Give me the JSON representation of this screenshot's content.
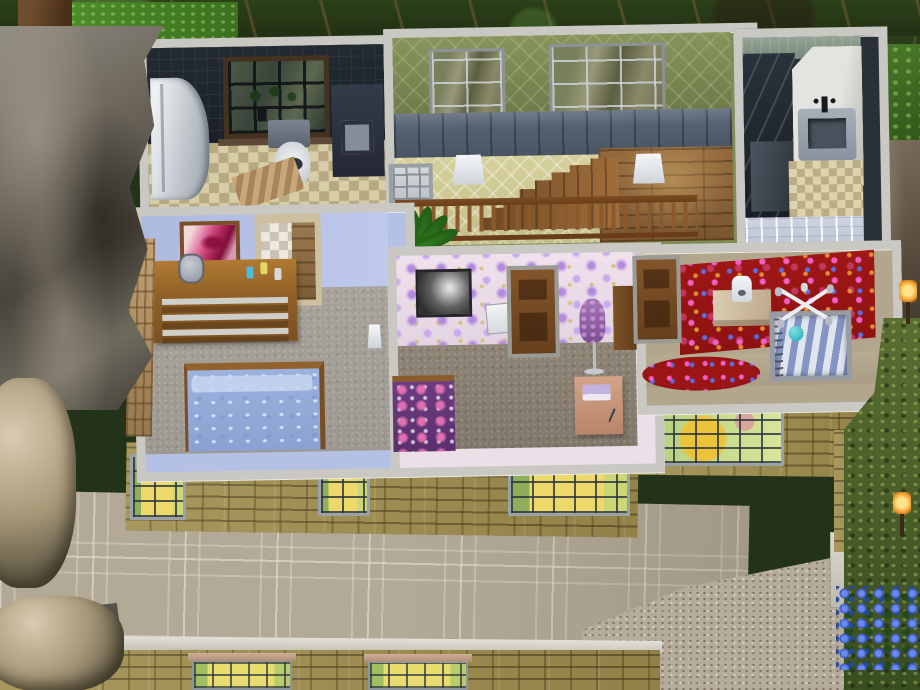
{
  "scene": {
    "view": "isometric dollhouse cutaway of a house upper floor, no HUD or text visible",
    "rooms": [
      {
        "id": "bathroom",
        "label": "Dark tile bathroom",
        "wall_color": "#20262e",
        "floor": "beige checker tile",
        "furniture": [
          "corner shower stall",
          "dark-framed window with vine",
          "toilet",
          "dark vanity cabinet",
          "wood bath mat",
          "toilet paper holder"
        ]
      },
      {
        "id": "stair-hall",
        "label": "Stair hall landing",
        "wall_color": "#7e8c55",
        "wainscot_color": "#5b6878",
        "floor": "wood planks",
        "furniture": [
          "two large windows",
          "wood staircase going down",
          "wood balustrade railing",
          "potted palm plant",
          "two white wall sconces",
          "interior pass-through window"
        ]
      },
      {
        "id": "shower-room",
        "label": "Narrow shower room",
        "wall_color": "#2a3038",
        "floor": "checker tile and pale blue tile",
        "furniture": [
          "dark glass shower",
          "white counter",
          "sink with black faucet"
        ]
      },
      {
        "id": "blue-bedroom",
        "label": "Periwinkle bedroom",
        "wall_color": "#b4c0e4",
        "floor": "gray carpet",
        "furniture": [
          "pink lips painting",
          "wood dresser with mirror and bottles",
          "closet doorway with checker wallpaper",
          "double bed with blue swirl bedding",
          "vine trellis on wall",
          "small wall sconce"
        ]
      },
      {
        "id": "sewing-room",
        "label": "Lavender floral room",
        "wall_color": "#ecdfe8",
        "floor": "brown carpet",
        "furniture": [
          "black and white portrait",
          "white wall cabinet",
          "wood panel door",
          "dress form mannequin in purple",
          "purple patterned bed",
          "sewing table with fabric and scissors",
          "brown wardrobe"
        ]
      },
      {
        "id": "nursery",
        "label": "Red nursery",
        "wall_color": "#9c1515",
        "floor": "tan carpet with round red rug",
        "furniture": [
          "wood panel door",
          "changing table with white potty chair",
          "crib with blue striped bedding and teal ball",
          "white baby mobile"
        ]
      }
    ],
    "exterior": {
      "wall_material": "tan brick",
      "roof": "coffered square panel flat roof",
      "cut_wall_color": "#c9c8c2",
      "lit_windows": 6,
      "window_glow": "yellow-green interior light",
      "areas": [
        "gravel patio lower right",
        "gray stone cliff left",
        "dense tree canopy top",
        "bushes right",
        "blue flowers bottom right",
        "white lower wall band"
      ],
      "lights": [
        "torch lamp upper right",
        "torch lamp lower right"
      ]
    },
    "palette": {
      "cut_wall": "#c9c8c2",
      "brick": "#a29050",
      "roof_panel": "#b2a996",
      "bathroom_wall": "#20262e",
      "hall_wallpaper": "#7e8c55",
      "wainscot": "#5b6878",
      "stairwell_wallpaper": "#d2cd99",
      "bedroom_wall": "#b4c0e4",
      "sewing_wallpaper": "#ecdfe8",
      "nursery_red": "#9c1515",
      "bedding_blue": "#9cb2de",
      "carpet_gray": "#a6a198",
      "carpet_brown": "#8b8173",
      "carpet_tan": "#b2a78e",
      "wood_floor": "#8a6036",
      "canopy_green": "#233a18",
      "rock_gray": "#6b655a",
      "gravel": "#b5ab9b",
      "window_glow": "#edd86a"
    }
  }
}
